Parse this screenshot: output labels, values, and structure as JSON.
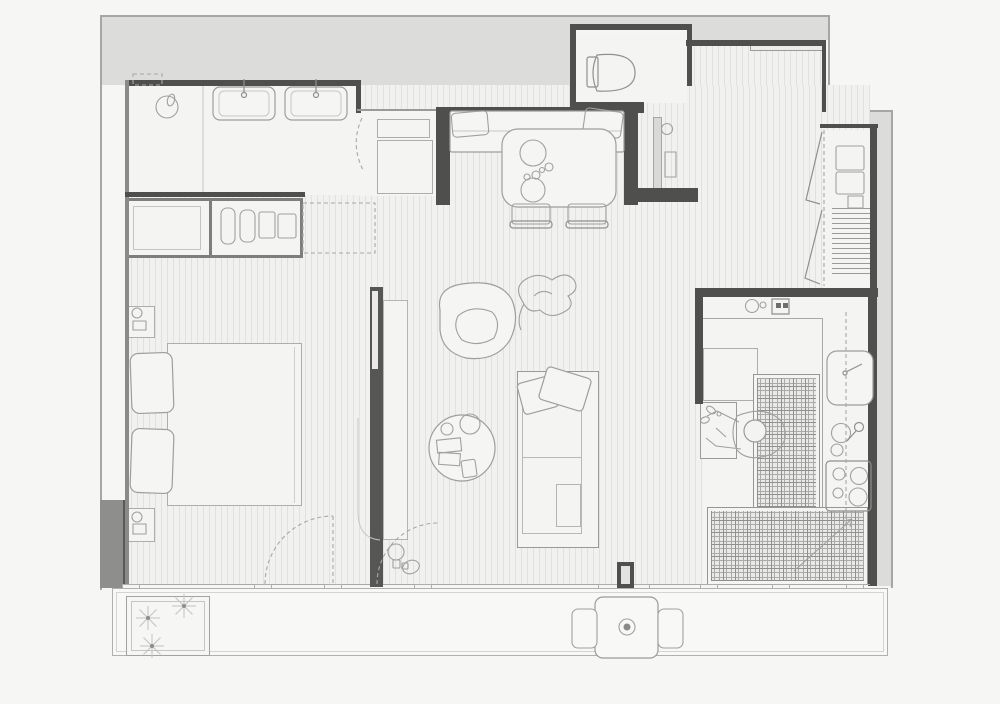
{
  "document": {
    "kind": "architectural floor plan",
    "view": "top-down line drawing",
    "canvas": {
      "width": 1000,
      "height": 704
    }
  },
  "palette": {
    "bg": "#f6f6f4",
    "exterior": "#dcdcda",
    "floor": "#f1f1ef",
    "room": "#f4f4f2",
    "wall": "#4f4f4d",
    "wallMid": "#7e7e7c",
    "line": "#adadab",
    "lineDark": "#8f8f8d",
    "tileBase": "#e9e9e7",
    "tileLine": "#90908e",
    "post": "#565654"
  },
  "rooms": {
    "bathroom": {
      "label": "bathroom",
      "items": [
        "shower-drain",
        "double-vanity",
        "faucets",
        "wall-niche",
        "door-swing"
      ]
    },
    "vestibule": {
      "label": "bathroom-vestibule",
      "items": [
        "cabinet-small",
        "cabinet-large"
      ]
    },
    "wc": {
      "label": "toilet-room",
      "items": [
        "toilet"
      ]
    },
    "dining": {
      "label": "dining-nook",
      "items": [
        "bench-seat",
        "seat-cushions",
        "dining-table",
        "plates",
        "cups",
        "chair-left",
        "chair-right"
      ]
    },
    "hall": {
      "label": "entry-hall",
      "items": [
        "entry-door-leaf",
        "wall-fixture-round",
        "wall-cabinet",
        "half-wall"
      ]
    },
    "closet": {
      "label": "utility-closet",
      "items": [
        "stacked-appliances",
        "shelving",
        "bifold-doors"
      ]
    },
    "bedroom": {
      "label": "bedroom",
      "items": [
        "wardrobe",
        "hanging-clothes",
        "wardrobe-ghost-extension",
        "bed-duvet",
        "pillows",
        "nightstand-upper",
        "nightstand-lower",
        "balcony-door-swing"
      ]
    },
    "living": {
      "label": "living-room",
      "items": [
        "sliding-partition",
        "partition-panel",
        "lounge-chair",
        "plant",
        "coffee-table",
        "tray-items",
        "daybed-sofa",
        "sofa-pillows",
        "blanket",
        "floor-lamps",
        "balcony-door-swing"
      ]
    },
    "kitchen": {
      "label": "kitchen",
      "items": [
        "counter-top-run",
        "sink-round",
        "small-appliance",
        "corner-cabinet",
        "prep-island",
        "cook-figure",
        "fridge",
        "counter-right-run",
        "sink-double",
        "faucet",
        "cooktop-4-burner",
        "tiled-floor-upper",
        "tiled-floor-lower",
        "section-dash-line",
        "floor-diagonal-mark",
        "wall-post"
      ]
    },
    "balcony": {
      "label": "balcony",
      "items": [
        "planter-box",
        "plants",
        "outdoor-table",
        "table-centerpiece",
        "outdoor-chair-left",
        "outdoor-chair-right",
        "glazed-facade",
        "window-mullions"
      ]
    }
  }
}
